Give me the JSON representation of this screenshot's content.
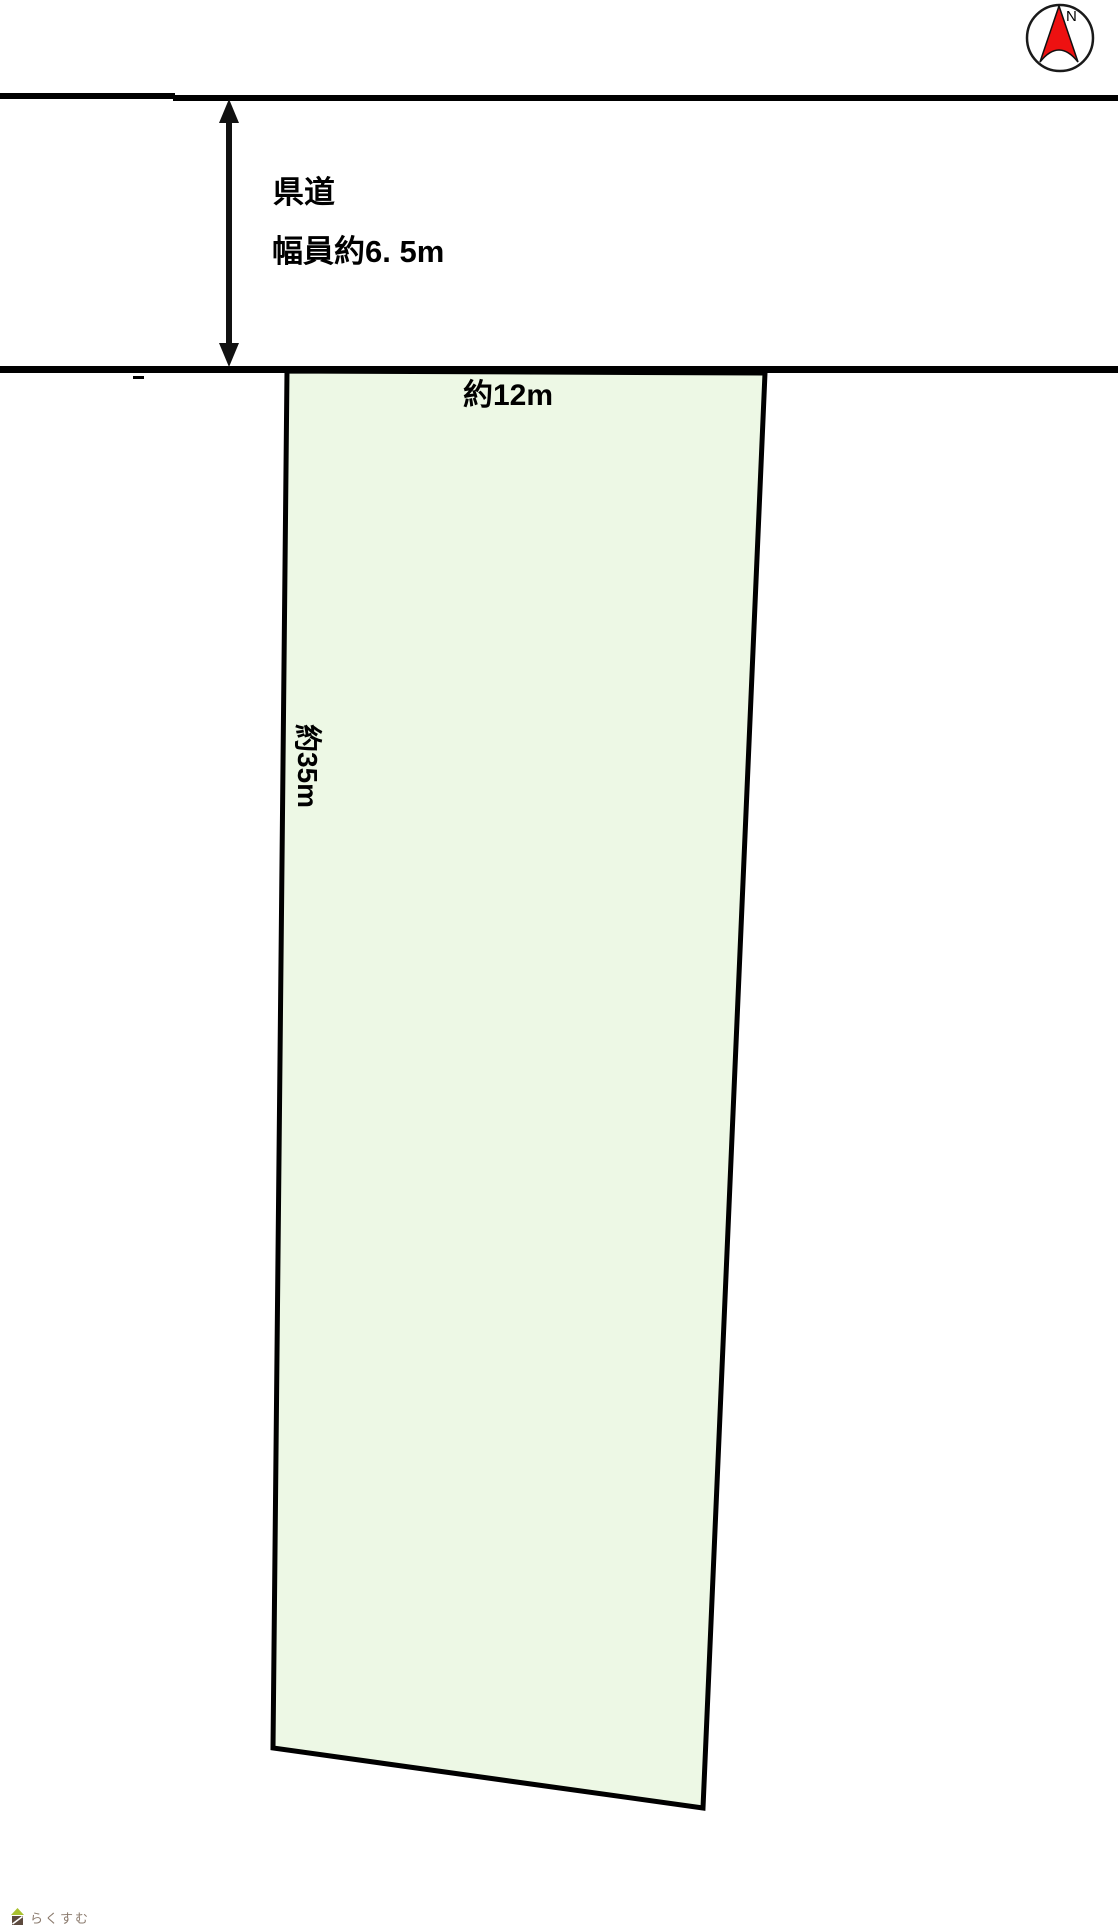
{
  "canvas": {
    "width": 1118,
    "height": 1930,
    "background": "#ffffff"
  },
  "compass": {
    "label": "N",
    "needle_color": "#ee1111",
    "ring_color": "#1a1a1a"
  },
  "road": {
    "name_label": "県道",
    "width_label": "幅員約6. 5m",
    "line_color": "#000000"
  },
  "parcel": {
    "frontage_label": "約12m",
    "depth_label": "約35m",
    "fill_color": "#edf8e5",
    "border_color": "#000000"
  },
  "arrow": {
    "color": "#111111"
  },
  "logo": {
    "text": "らくすむ",
    "roof_color": "#a9c12f",
    "body_color": "#5d4a3e",
    "stripe_color": "#ffffff",
    "text_color": "#8b7b6e"
  }
}
